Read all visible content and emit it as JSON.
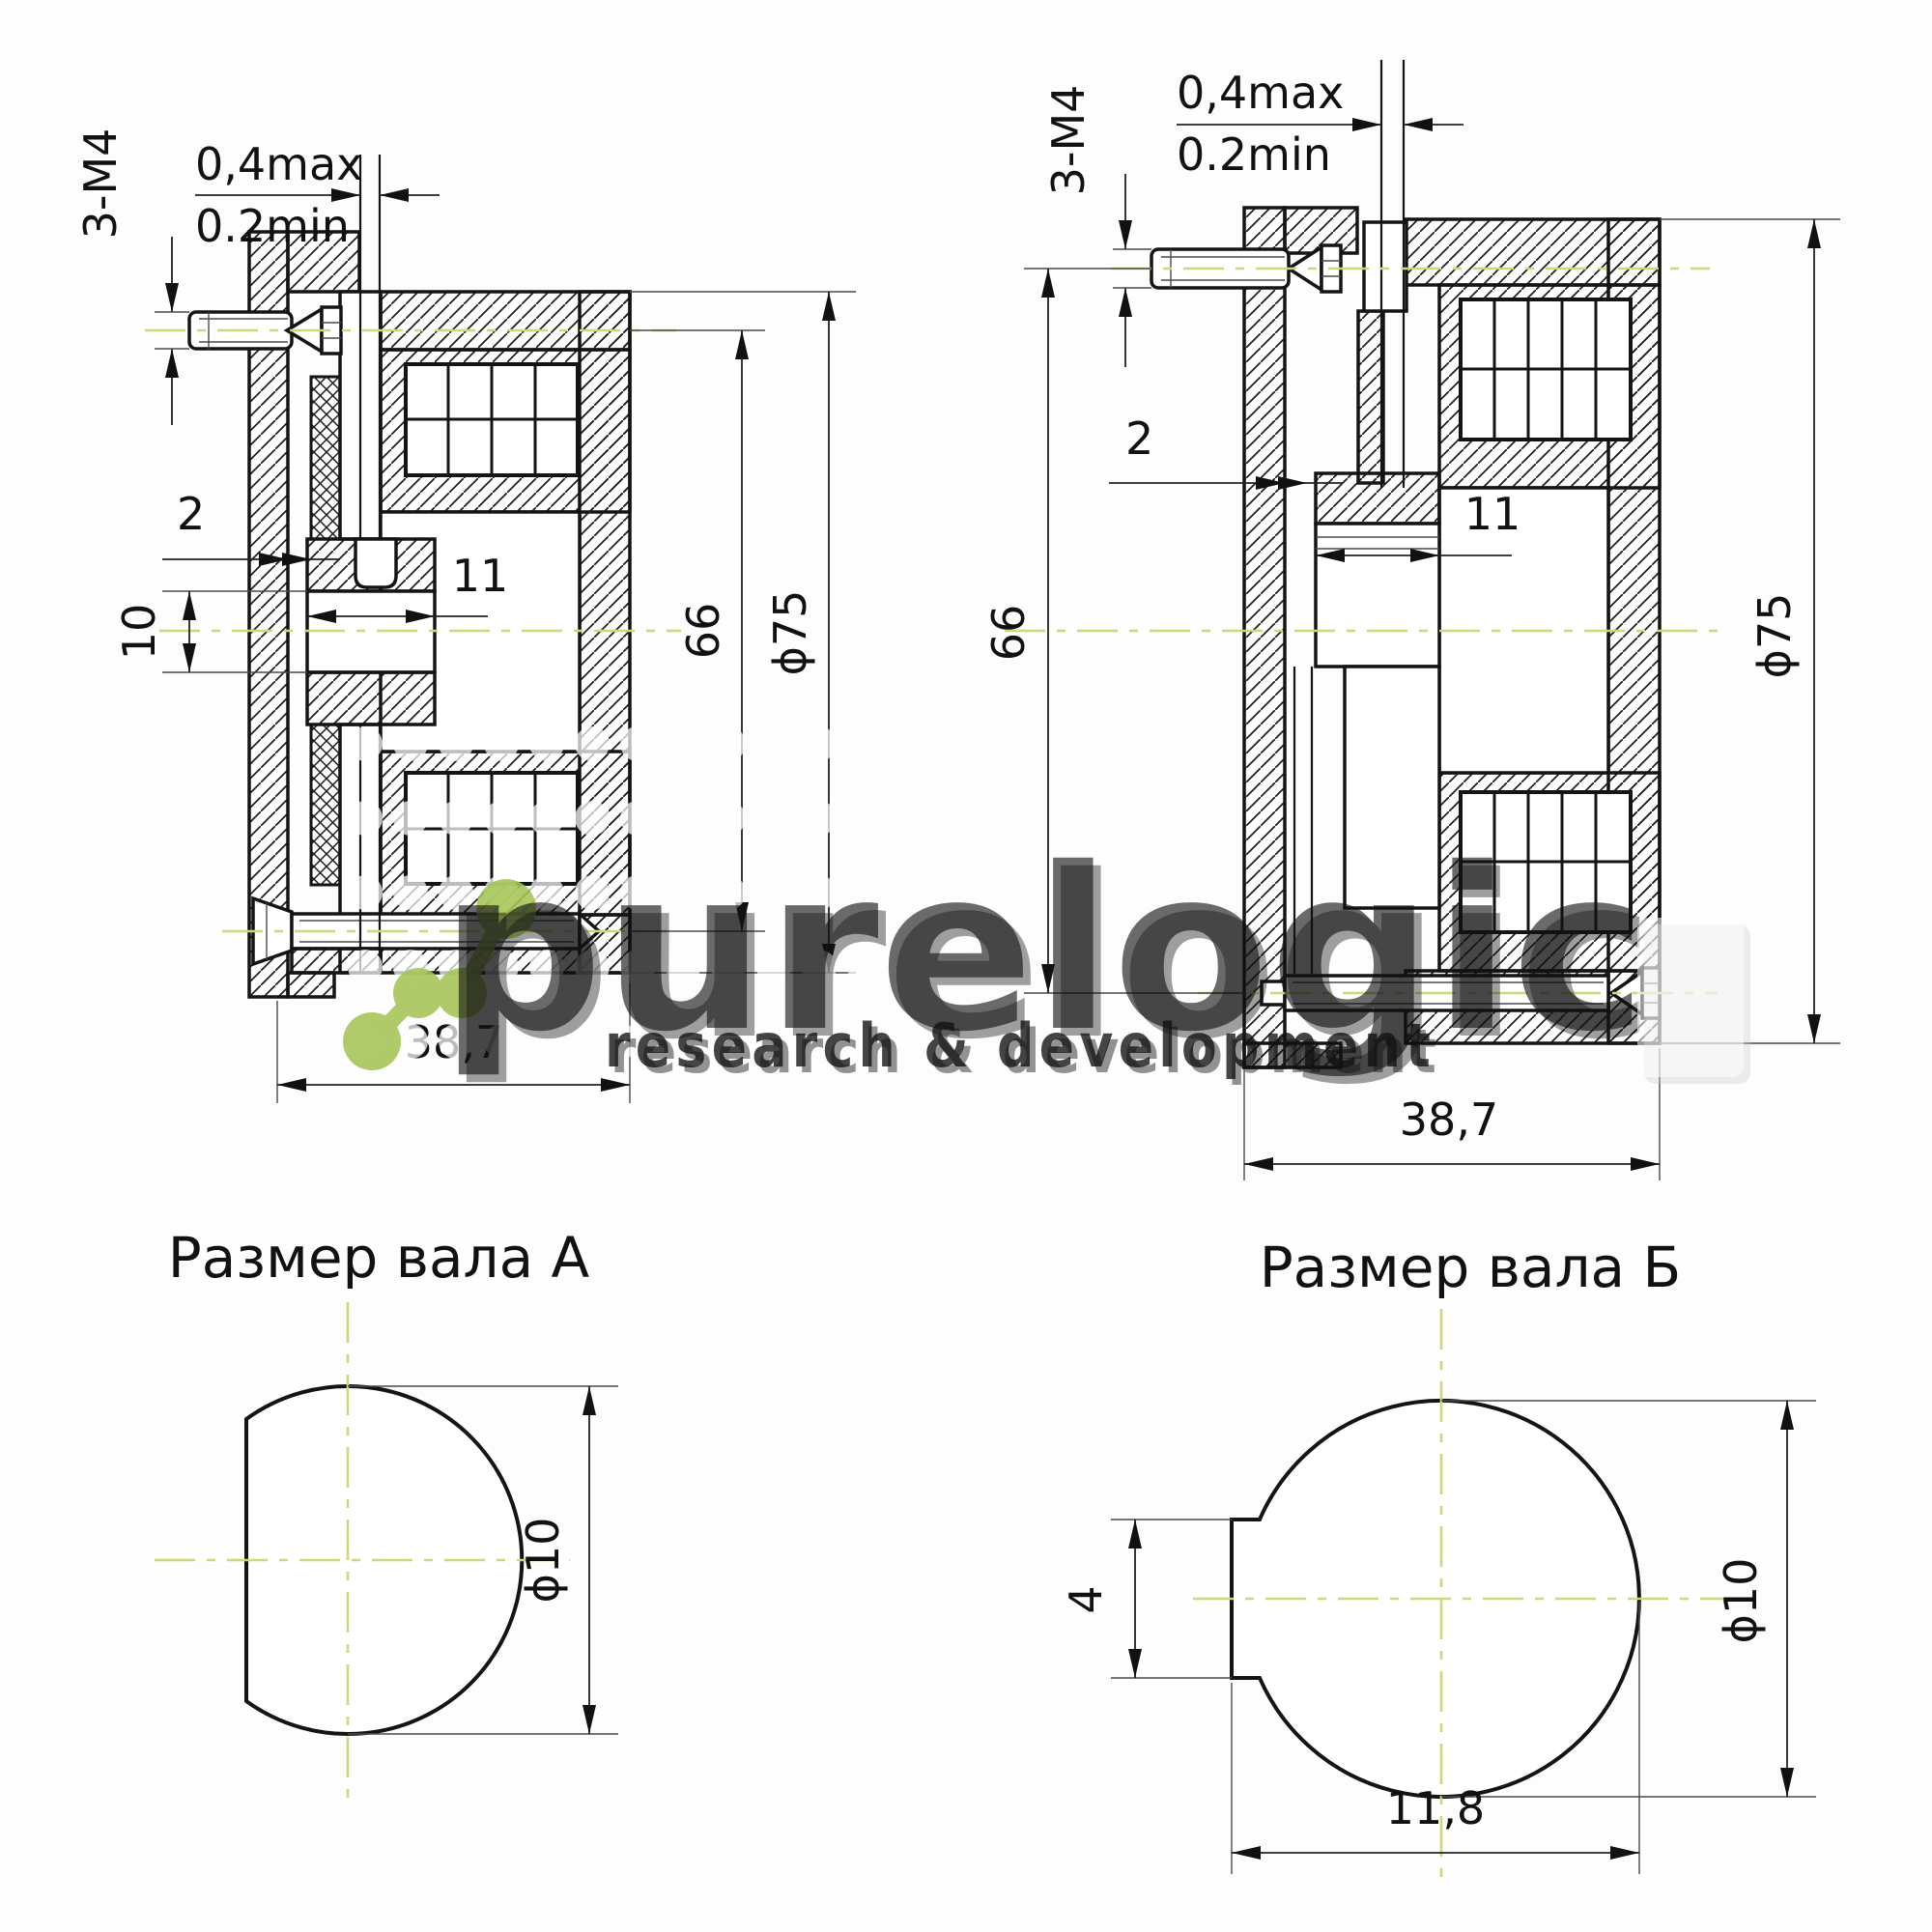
{
  "watermark": {
    "brand": "purelogic",
    "tagline": "research & development",
    "accent_color": "#a6c455"
  },
  "colors": {
    "centerline": "#ccd97a",
    "line": "#141414"
  },
  "view_a": {
    "bolt_thread": "3-M4",
    "gap_max": "0,4max",
    "gap_min": "0.2min",
    "flange_offset": "2",
    "bore_dia": "10",
    "hub_length": "11",
    "mount_circle": "66",
    "outer_dia": "ϕ75",
    "total_length": "38,7"
  },
  "view_b": {
    "bolt_thread": "3-M4",
    "gap_max": "0,4max",
    "gap_min": "0.2min",
    "flange_offset": "2",
    "hub_length": "11",
    "mount_circle": "66",
    "outer_dia": "ϕ75",
    "total_length": "38,7"
  },
  "shaft_a": {
    "title": "Размер вала А",
    "dia": "ϕ10"
  },
  "shaft_b": {
    "title": "Размер вала Б",
    "flat_width": "4",
    "dia": "ϕ10",
    "length": "11,8"
  }
}
